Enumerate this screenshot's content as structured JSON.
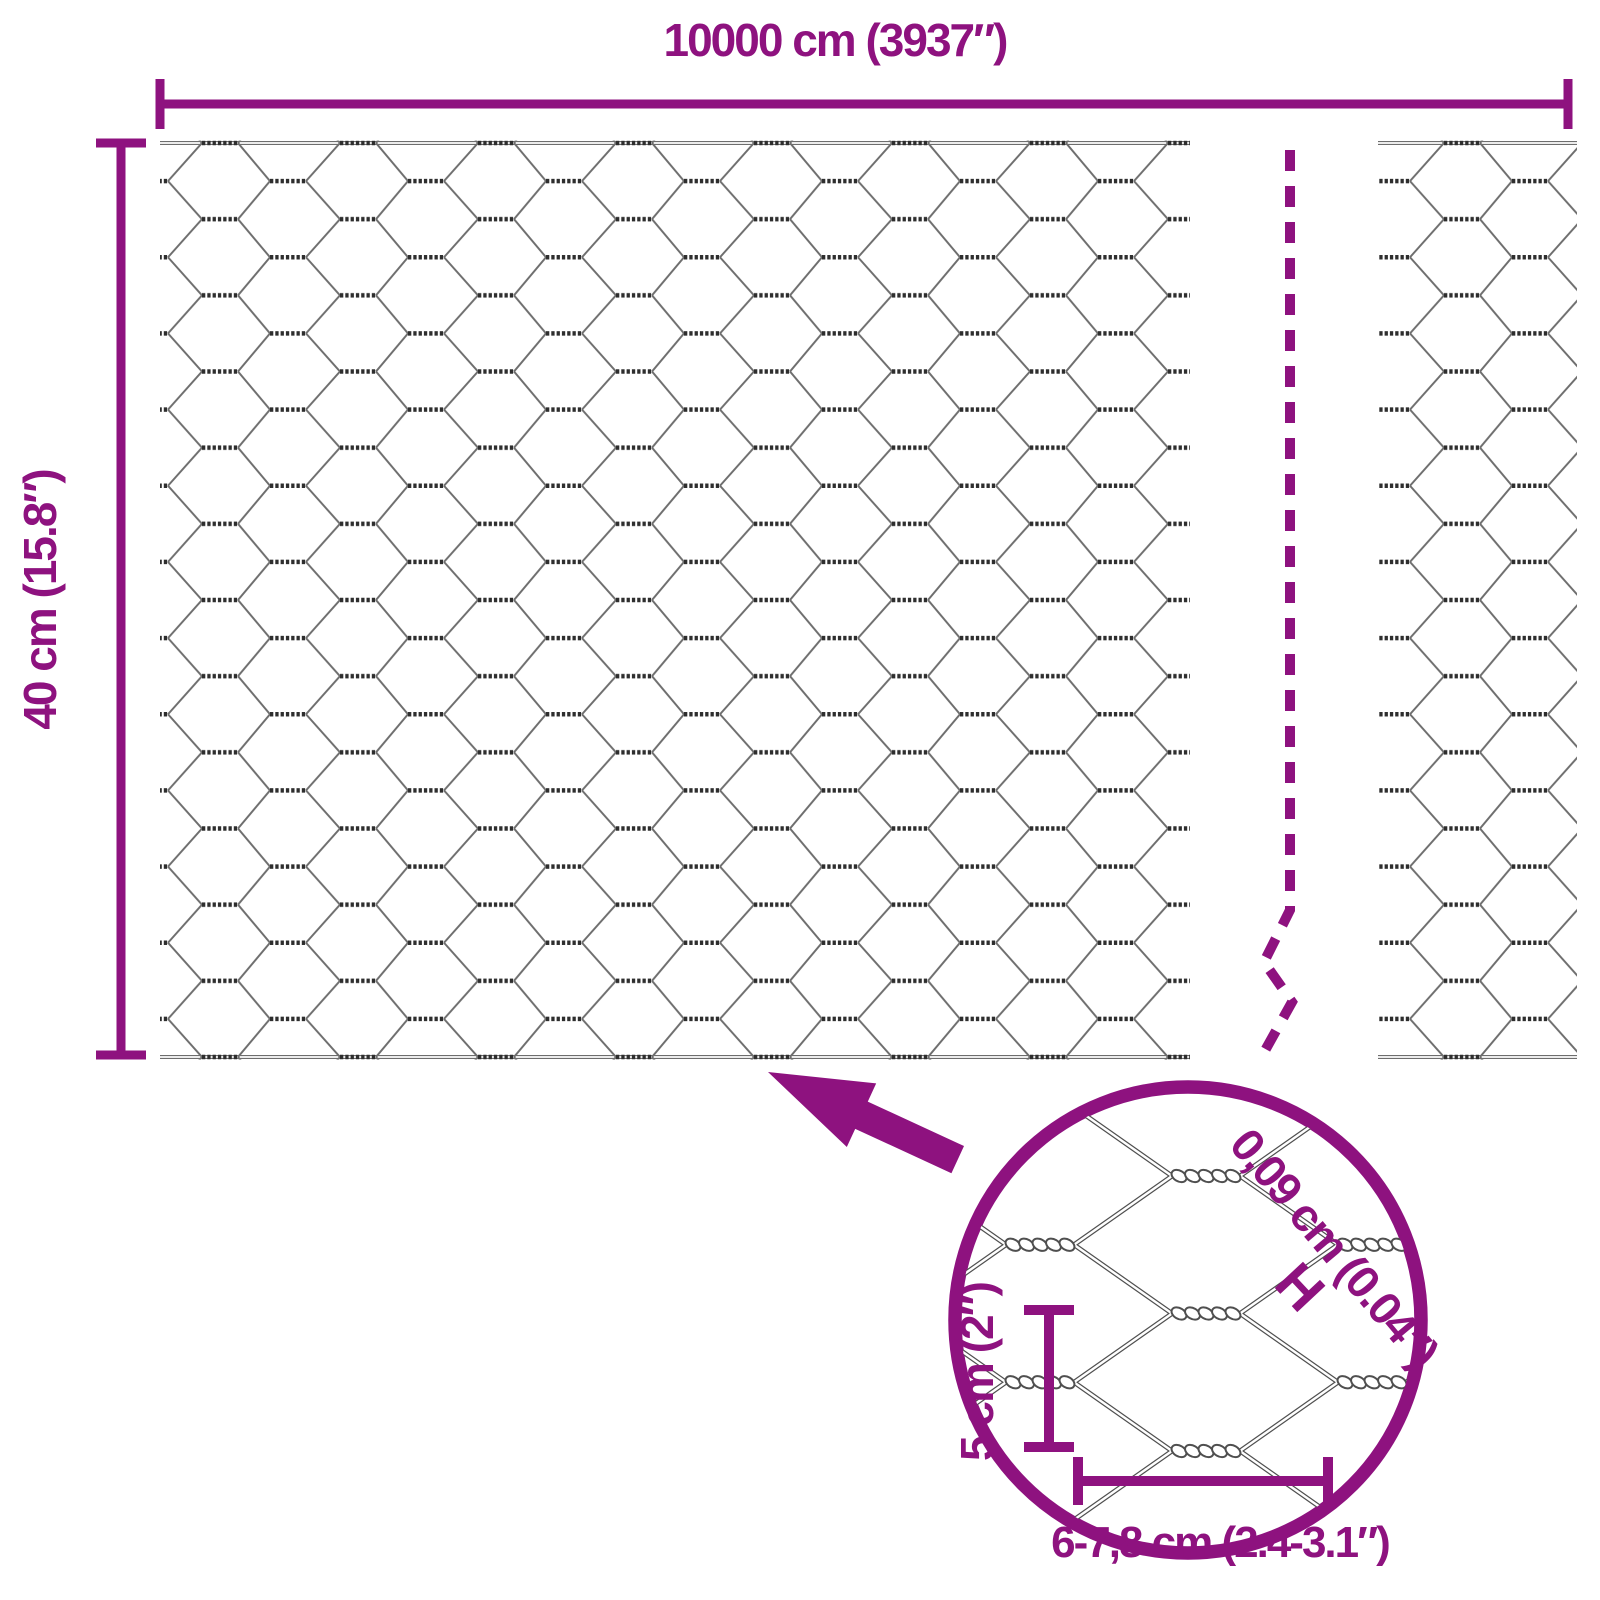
{
  "colors": {
    "accent": "#8E127F",
    "wire": "#6e6e6e",
    "twist": "#2e2e2e",
    "inset_wire": "#4f4f4f"
  },
  "dimensions": {
    "total_width_label": "10000 cm (3937″)",
    "height_label": "40 cm (15.8″)"
  },
  "inset": {
    "wire_thickness_label": "0,09 cm (0.04″)",
    "wire_thickness_marker": "H",
    "mesh_height_label": "5 cm (2″)",
    "mesh_width_label": "6-7,8 cm (2.4-3.1″)"
  }
}
